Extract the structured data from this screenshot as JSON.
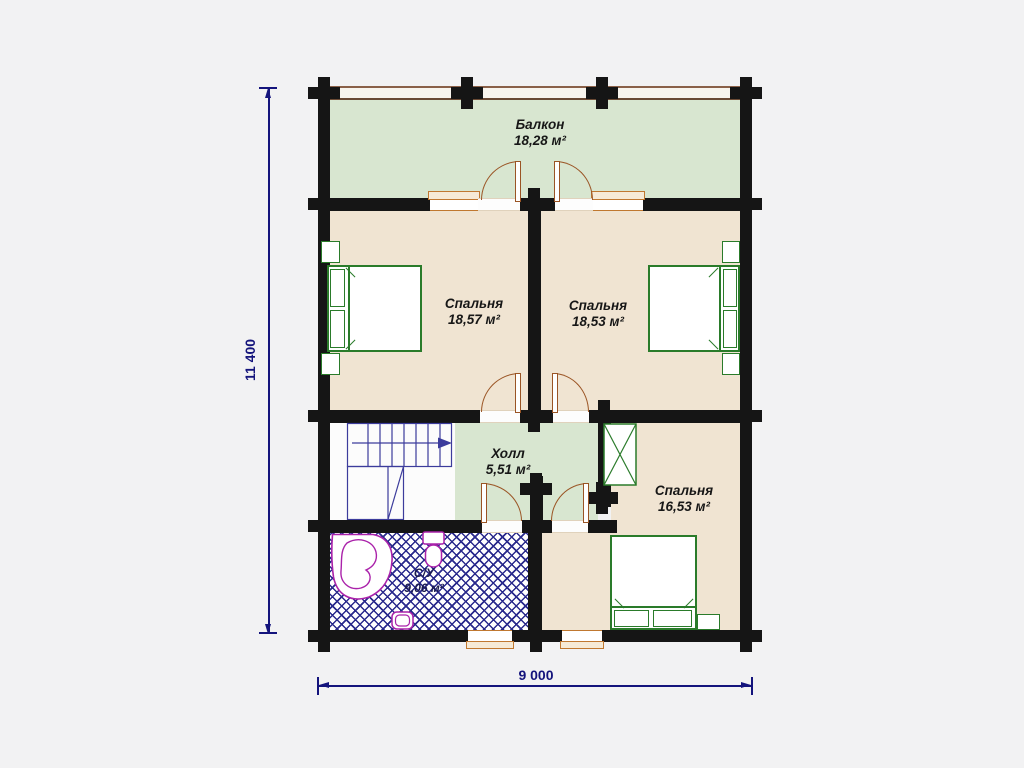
{
  "plan": {
    "rooms": {
      "balcony": {
        "name": "Балкон",
        "area": "18,28 м²"
      },
      "bedroom_left": {
        "name": "Спальня",
        "area": "18,57 м²"
      },
      "bedroom_right": {
        "name": "Спальня",
        "area": "18,53 м²"
      },
      "hall": {
        "name": "Холл",
        "area": "5,51 м²"
      },
      "bedroom_bottom": {
        "name": "Спальня",
        "area": "16,53 м²"
      },
      "bathroom": {
        "name": "С/У",
        "area": "9,06 м²"
      }
    },
    "dimensions": {
      "vertical": "11 400",
      "horizontal": "9 000"
    },
    "colors": {
      "wall": "#151515",
      "balcony_hall_floor": "#d8e6d0",
      "bedroom_floor": "#f0e4d2",
      "furniture_outline": "#2a7b2a",
      "stairs_outline": "#3c3c9c",
      "bathroom_hatch": "#2a2a8c",
      "fixtures_outline": "#aa22aa",
      "door_arc": "#9a5424",
      "window_frame": "#c07830",
      "dimension": "#14147c"
    }
  }
}
